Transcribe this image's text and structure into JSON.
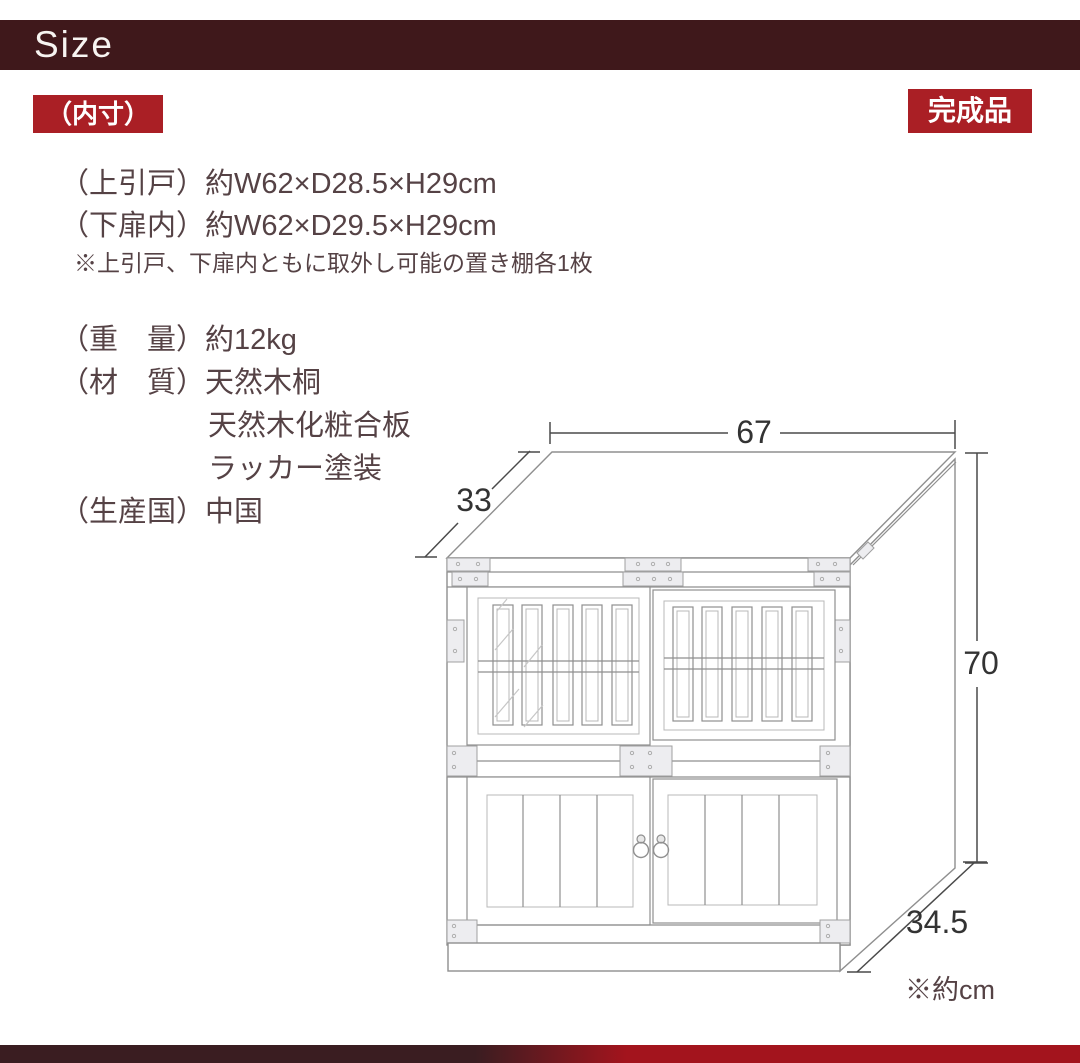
{
  "header": {
    "title": "Size"
  },
  "badges": {
    "inner": "（内寸）",
    "finished": "完成品"
  },
  "specs": {
    "upper_door": "（上引戸）約W62×D28.5×H29cm",
    "lower_door": "（下扉内）約W62×D29.5×H29cm",
    "note": "※上引戸、下扉内ともに取外し可能の置き棚各1枚",
    "weight": "（重　量）約12kg",
    "material_1": "（材　質）天然木桐",
    "material_2": "天然木化粧合板",
    "material_3": "ラッカー塗装",
    "country": "（生産国）中国"
  },
  "diagram": {
    "width": "67",
    "depth_top": "33",
    "height": "70",
    "depth_bottom": "34.5",
    "unit_note": "※約cm"
  },
  "colors": {
    "bar-color": "#3f181b",
    "accent": "#aa1f25",
    "text-color": "#554245",
    "line-color": "#8f8f8f",
    "dim-color": "#4a4a4a",
    "dim-text": "#333333",
    "footer-left": "#3a1d21",
    "footer-right": "#a3141d"
  }
}
